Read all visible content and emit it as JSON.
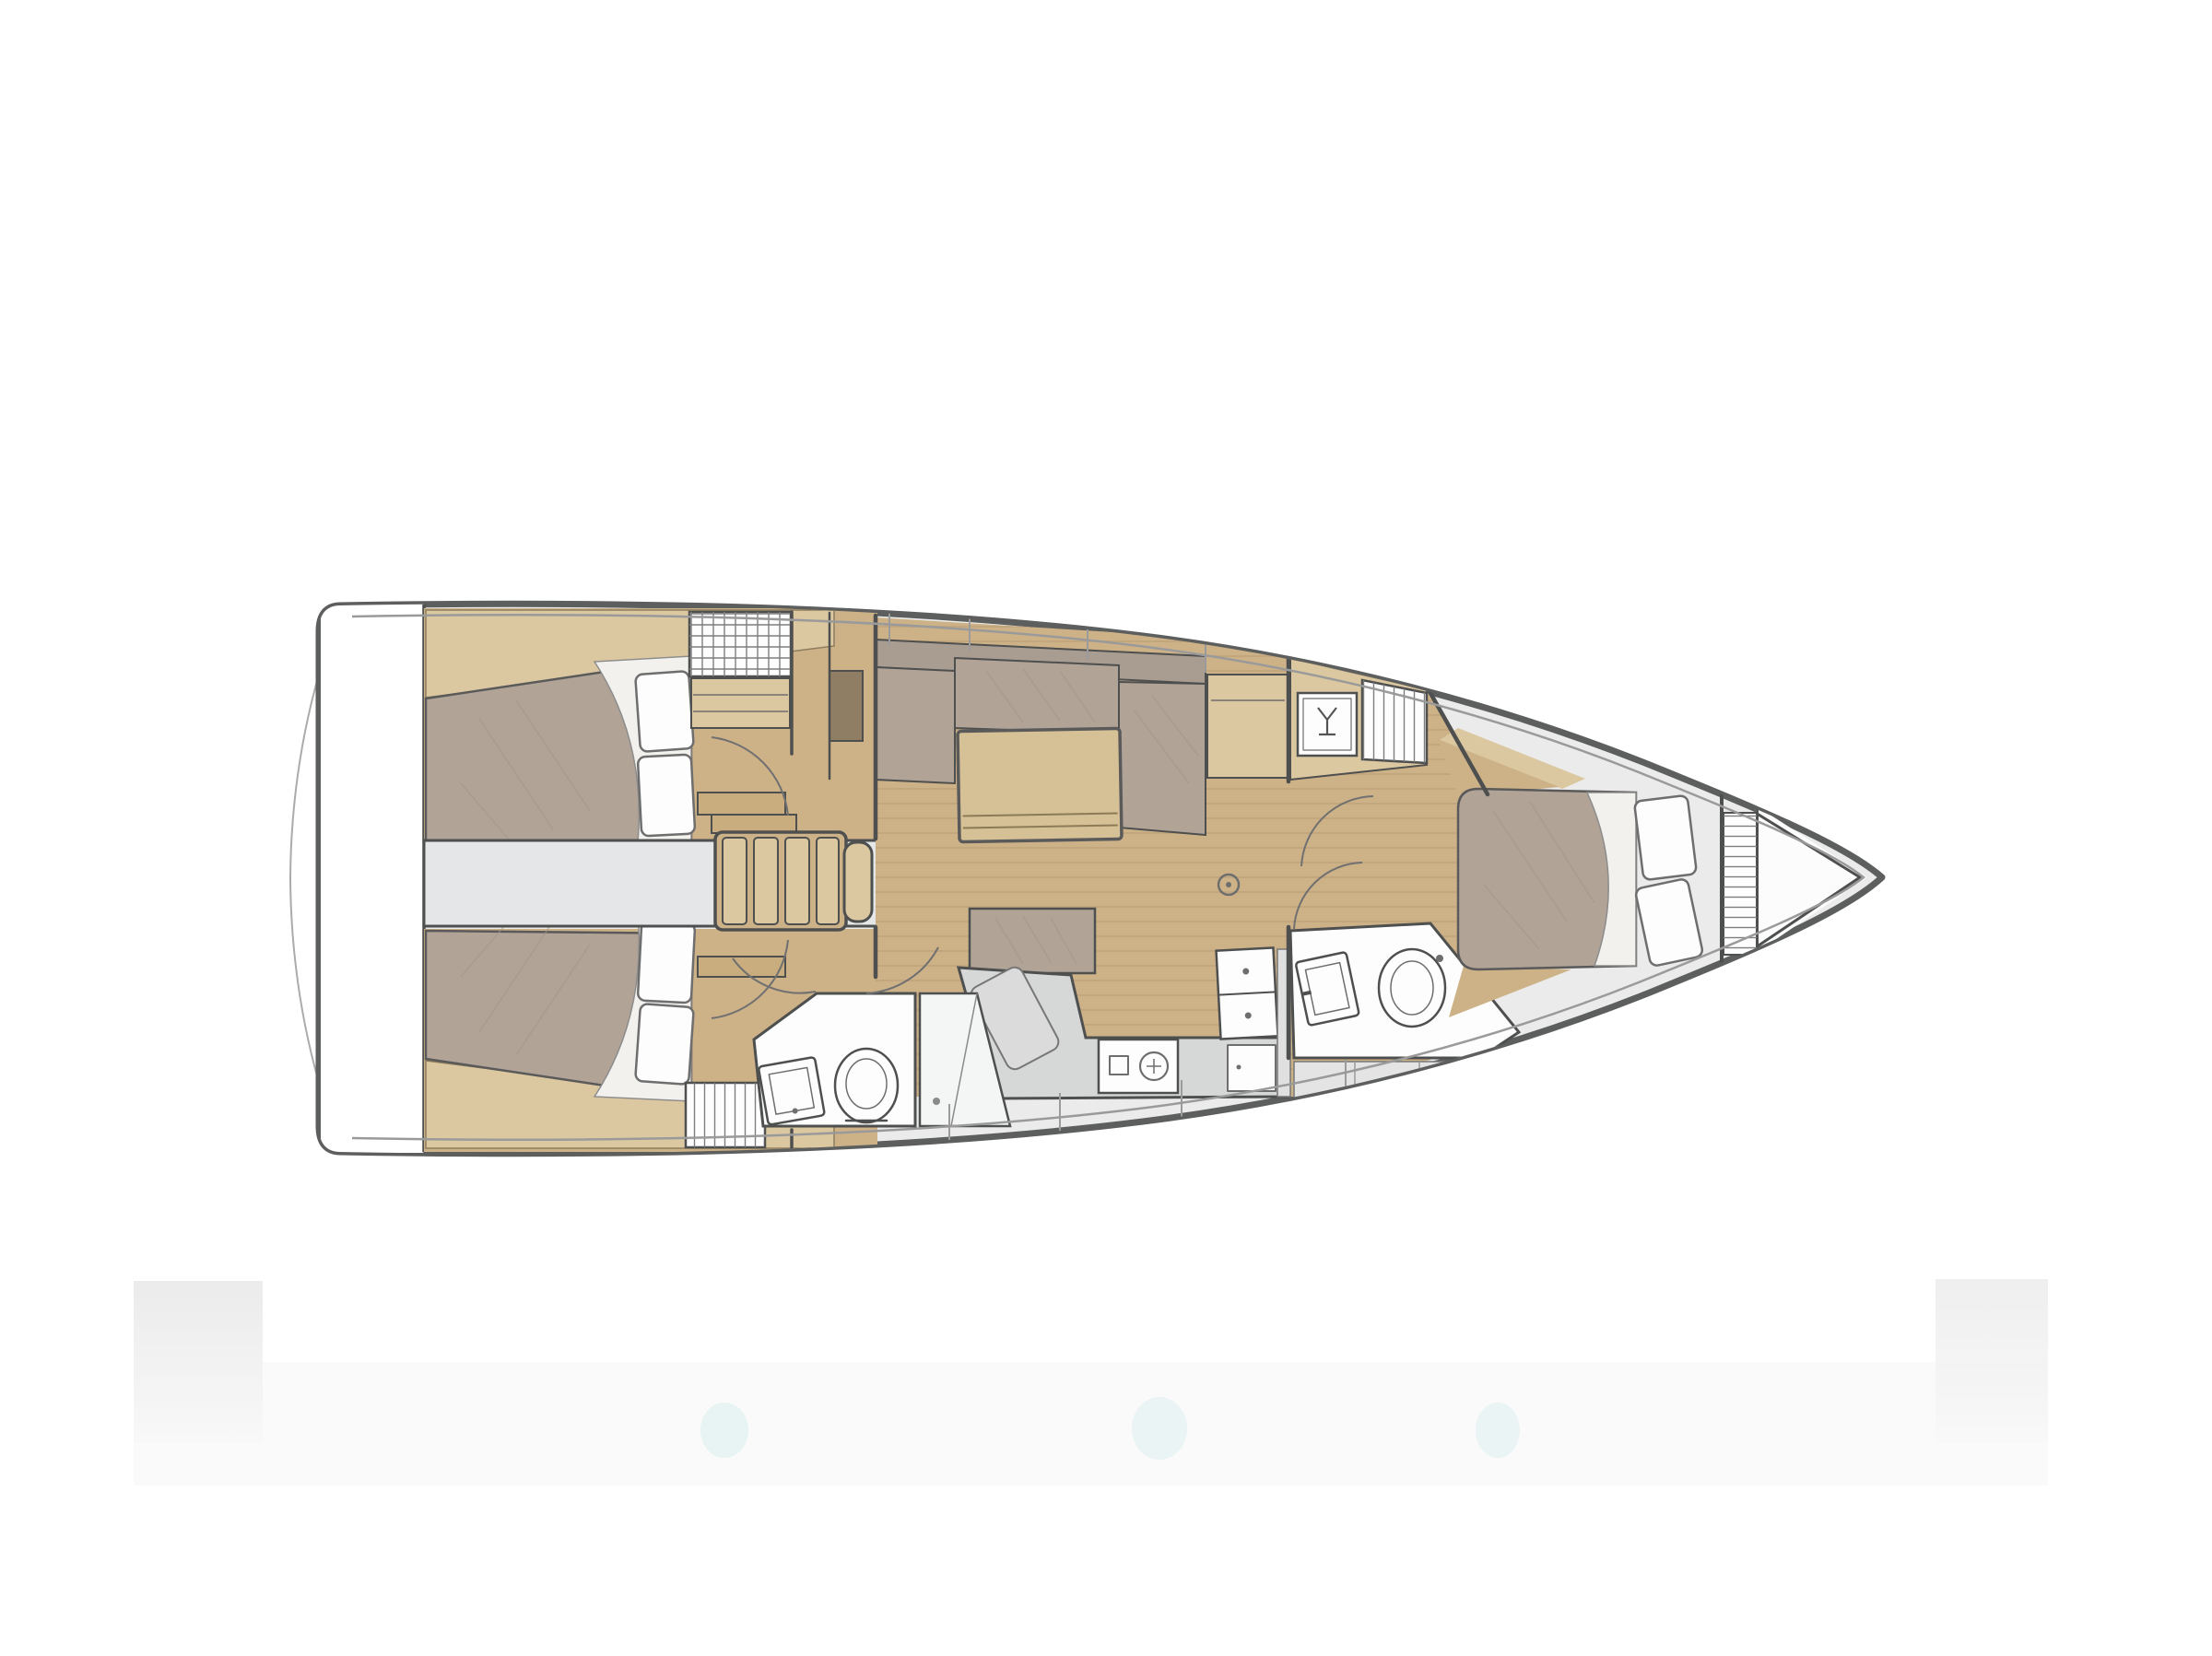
{
  "figure": {
    "alt": "Sailing yacht interior layout floor plan, bow pointing right: two aft double cabins, engine corridor with companionway steps, saloon with L-shaped settee and table, galley with stove and double sink, aft head with shower, forward head, and forward double cabin"
  },
  "colors": {
    "background": "#ffffff",
    "hull_outline": "#5d5e5e",
    "inner_sheer": "#9a9a9a",
    "wall": "#4e4f4f",
    "deck": "#ebebeb",
    "floor_wood": "#cdb288",
    "wood_light": "#dcc8a0",
    "wood_mid": "#c9ad7e",
    "bed": "#b2a397",
    "bed_shade": "#a2958a",
    "sofa_back": "#a99c91",
    "sheet": "#f2f1ee",
    "table_wood": "#d6c096",
    "white_fixture": "#fdfdfd",
    "fixture_line": "#6e6e6e",
    "counter": "#d6d7d7",
    "corridor": "#e4e6e7",
    "cutting_board": "#dbdbdb",
    "dark_cabinet": "#8f7e64",
    "hatch_line": "#7e7e7e",
    "arc_line": "#707070",
    "band_gray": "#efefef",
    "band_faint": "#fafafa",
    "band_smudge": "#d9edef"
  },
  "icons": [
    "wine-glass-icon",
    "toilet-icon",
    "sink-icon",
    "stove-burners-icon",
    "companionway-steps-icon",
    "hanging-locker-hatch-icon",
    "cross-hatch-locker-icon",
    "table-leg-ring-icon"
  ]
}
